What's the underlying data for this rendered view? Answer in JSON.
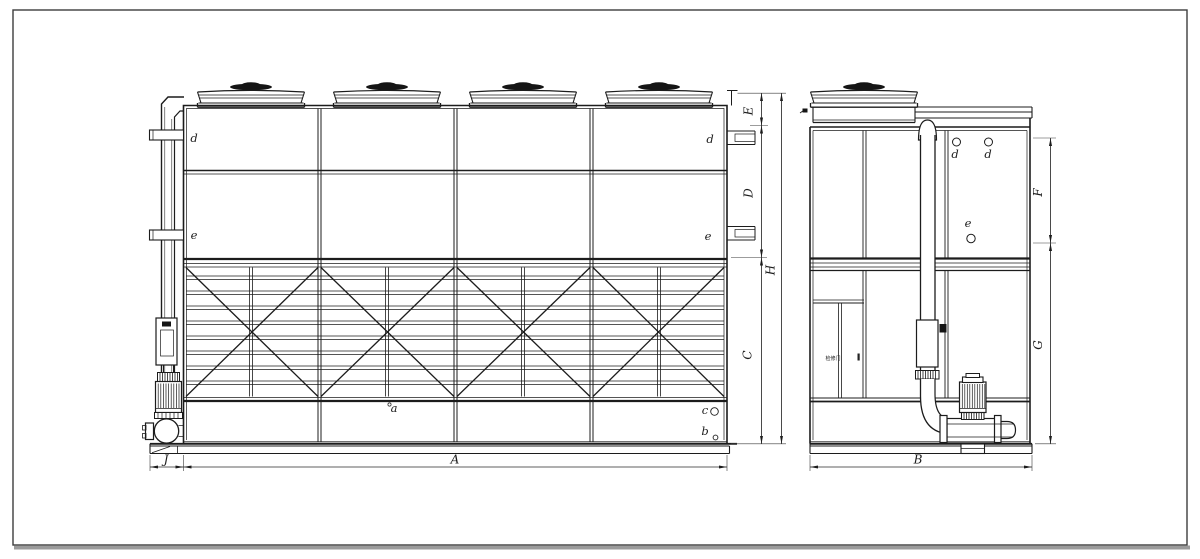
{
  "drawing": {
    "description": "Closed-circuit cooling tower engineering drawing: front elevation (left) and side elevation (right) with external piping, vertical inline pumps, fan cowls, louver screens and dimension callouts",
    "colors": {
      "line": "#1c1c1c",
      "background": "#ffffff",
      "border": "#3d3d3d",
      "shadow": "#9b9b9b",
      "dark_fill": "#151515"
    }
  },
  "front_view": {
    "part_labels": {
      "d_left": "d",
      "d_right": "d",
      "e_left": "e",
      "e_right": "e",
      "a": "a",
      "b": "b",
      "c": "c"
    },
    "dim_labels": {
      "A": "A",
      "C": "C",
      "D": "D",
      "E": "E",
      "H": "H",
      "J": "J"
    }
  },
  "side_view": {
    "part_labels": {
      "d1": "d",
      "d2": "d",
      "e": "e"
    },
    "door_label": "检修门",
    "dim_labels": {
      "B": "B",
      "F": "F",
      "G": "G"
    }
  }
}
